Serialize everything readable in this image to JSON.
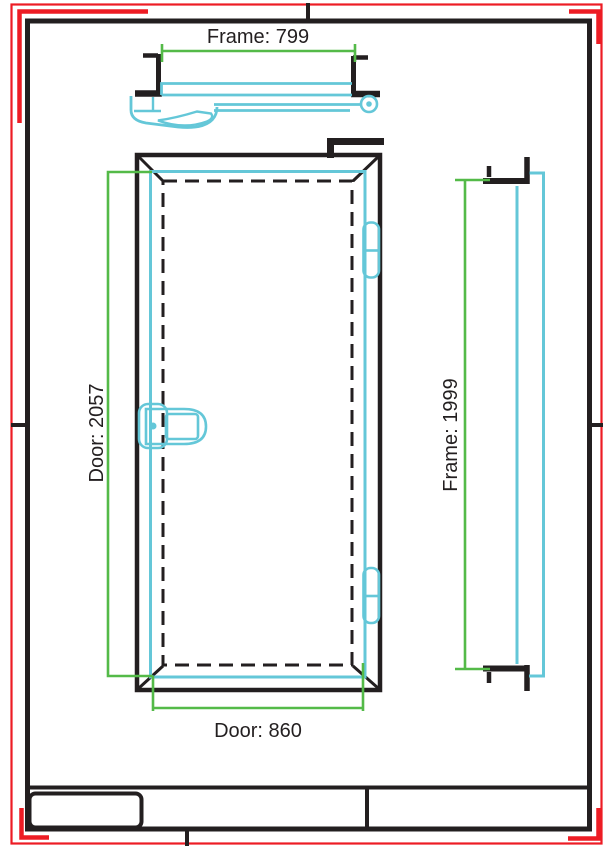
{
  "sheet": {
    "type": "door technical drawing sheet",
    "background": "#ffffff",
    "colors": {
      "drawing_black": "#231f20",
      "profile_cyan": "#64c7d8",
      "dimension_green": "#54ba48",
      "border_red": "#ed1c24"
    },
    "title_block": {
      "cells": [
        "",
        "",
        ""
      ]
    }
  },
  "dimensions": {
    "frame_width_label": "Frame: 799",
    "door_height_label": "Door: 2057",
    "door_width_label": "Door: 860",
    "frame_height_label": "Frame: 1999",
    "frame_width_value": 799,
    "door_height_value": 2057,
    "door_width_value": 860,
    "frame_height_value": 1999
  }
}
